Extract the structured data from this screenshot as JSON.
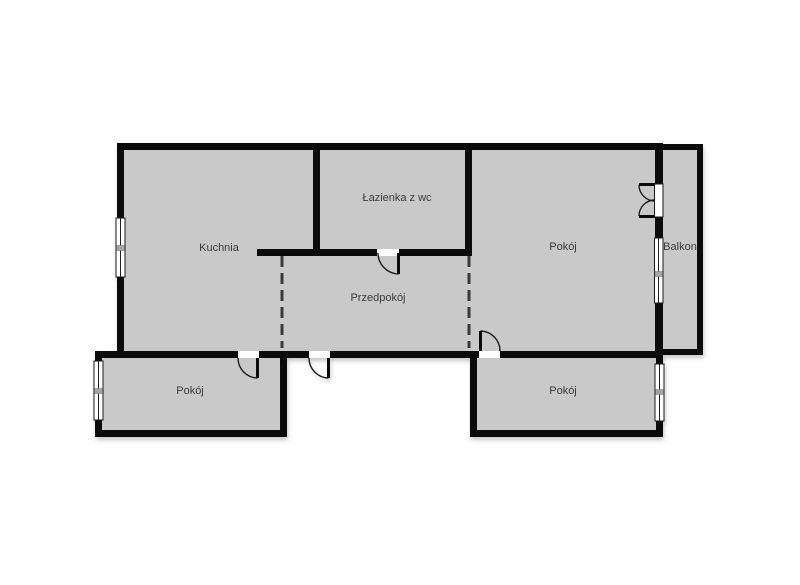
{
  "plan": {
    "type": "apartment-floor-plan",
    "colors": {
      "background": "#ffffff",
      "walls": "#0b0b0b",
      "floor": "#c9c9c9",
      "labels": "#3b3b3b",
      "window_mullion": "#a6a6a6"
    },
    "rooms": [
      {
        "name": "kitchen",
        "label": "Kuchnia"
      },
      {
        "name": "bathroom",
        "label": "Łazienka z wc"
      },
      {
        "name": "hallway",
        "label": "Przedpokój"
      },
      {
        "name": "room-top-right",
        "label": "Pokój"
      },
      {
        "name": "balcony",
        "label": "Balkon"
      },
      {
        "name": "room-bottom-left",
        "label": "Pokój"
      },
      {
        "name": "room-bottom-right",
        "label": "Pokój"
      }
    ]
  }
}
